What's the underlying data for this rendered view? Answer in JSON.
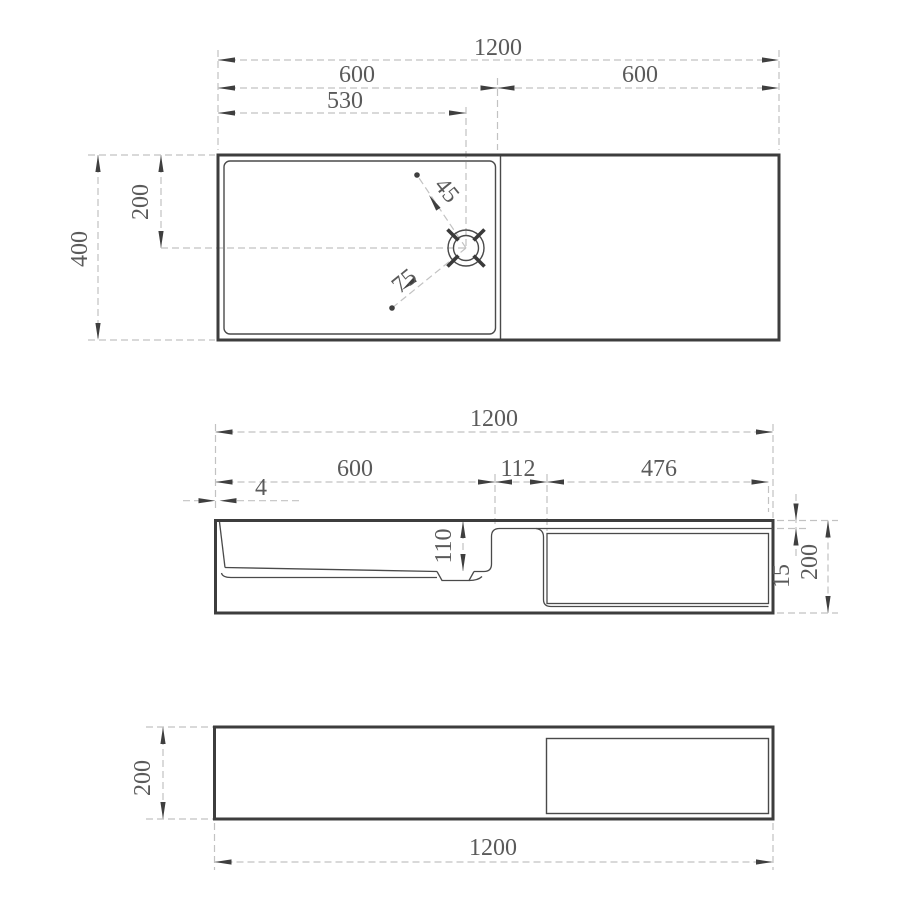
{
  "document": {
    "type": "technical dimension drawing",
    "background": "#ffffff"
  },
  "colors": {
    "outline": "#3d3d3d",
    "thin_line": "#4a4a4a",
    "dashed_line": "#c2c2c2",
    "dimension_text": "#5a5a5a",
    "arrow": "#3f3f3f"
  },
  "top_view": {
    "dims": {
      "overall_width": "1200",
      "basin_section_width": "600",
      "shelf_section_width": "600",
      "drain_offset_from_left": "530",
      "overall_depth": "400",
      "drain_offset_from_front": "200",
      "drain_leader_a": "45",
      "drain_leader_b": "75"
    }
  },
  "front_view": {
    "dims": {
      "overall_width": "1200",
      "basin_width": "600",
      "partition_width": "112",
      "niche_width": "476",
      "rim_lip": "4",
      "basin_depth": "110",
      "deck_thickness": "15",
      "overall_height": "200"
    }
  },
  "bottom_view": {
    "dims": {
      "overall_height": "200",
      "overall_width": "1200"
    }
  }
}
